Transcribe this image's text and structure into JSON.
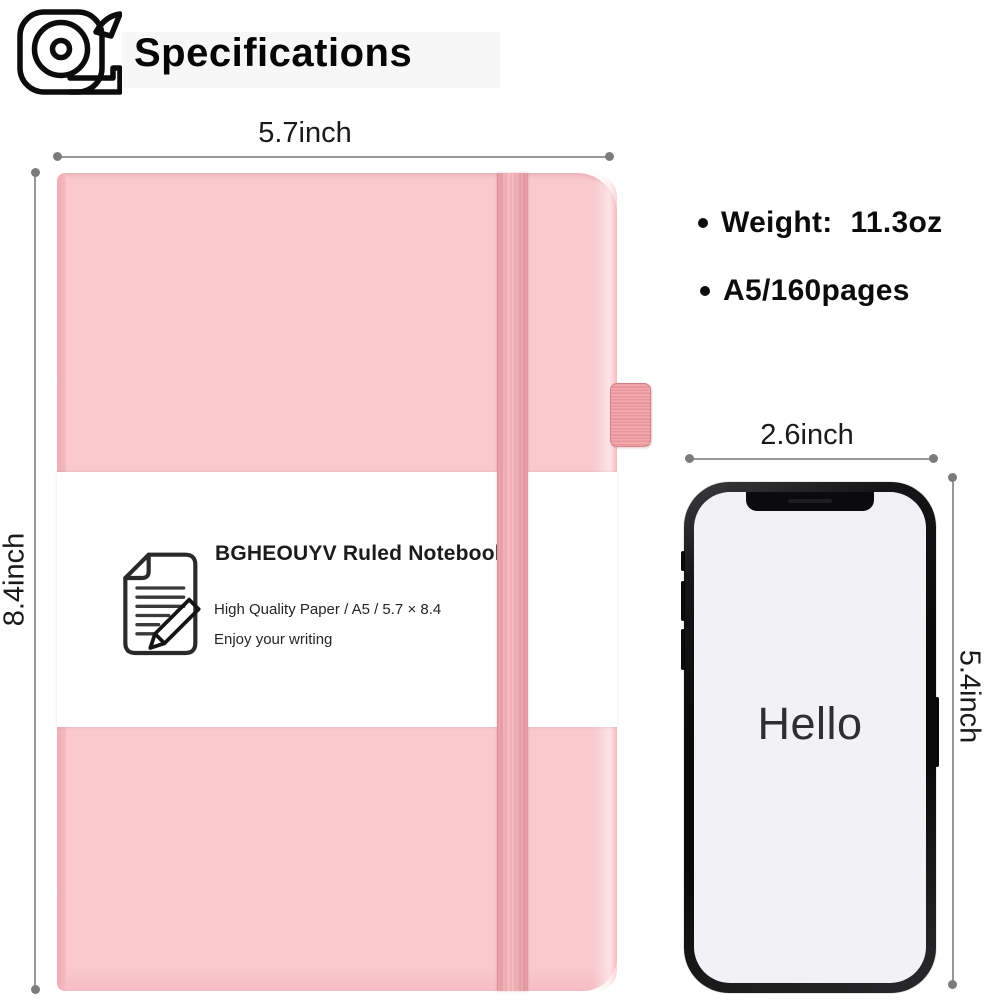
{
  "header": {
    "title": "Specifications",
    "icon": "measuring-tape-icon"
  },
  "notebook": {
    "width_label": "5.7inch",
    "height_label": "8.4inch",
    "belly_band": {
      "icon": "document-pencil-icon",
      "title": "BGHEOUYV Ruled Notebook",
      "line1": "High Quality Paper / A5 / 5.7 × 8.4",
      "line2": "Enjoy your writing"
    }
  },
  "specs": {
    "items": [
      {
        "label": "Weight:",
        "value": "11.3oz"
      },
      {
        "label": "A5/160pages",
        "value": ""
      }
    ]
  },
  "phone": {
    "width_label": "2.6inch",
    "height_label": "5.4inch",
    "screen_text": "Hello"
  },
  "colors": {
    "cover_pink": "#f9c9cd",
    "elastic_band_pink": "#f0a5ab",
    "pen_loop_pink": "#ee9aa1",
    "dimension_line_gray": "#979797",
    "phone_frame_black": "#0a0a0b",
    "phone_screen_gray": "#f2f2f5",
    "text_black": "#0c0c0c"
  }
}
